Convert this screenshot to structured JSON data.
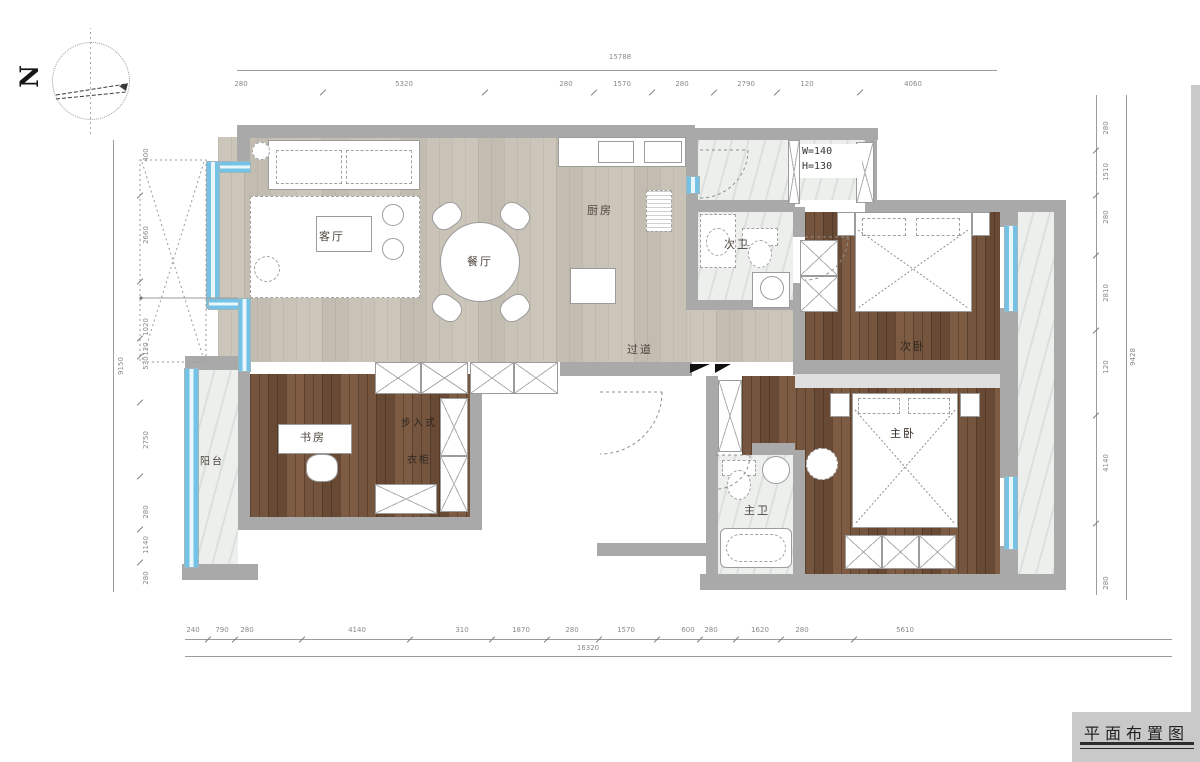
{
  "north_label": "N",
  "title": "平面布置图",
  "note": {
    "w": "W=140",
    "h": "H=130"
  },
  "rooms": {
    "living": "客厅",
    "dining": "餐厅",
    "kitchen": "厨房",
    "guest_bath": "次卫",
    "hallway": "过道",
    "guest_bedroom": "次卧",
    "master_bedroom": "主卧",
    "master_bath": "主卫",
    "study": "书房",
    "closet_line1": "步入式",
    "closet_line2": "衣柜",
    "balcony": "阳台"
  },
  "dimensions": {
    "top": {
      "total": "15788",
      "segments": [
        "280",
        "5320",
        "280",
        "1570",
        "280",
        "2790",
        "120",
        "4060"
      ]
    },
    "bottom": {
      "total": "16320",
      "segments": [
        "240",
        "790",
        "280",
        "4140",
        "310",
        "1870",
        "280",
        "1570",
        "600",
        "280",
        "1620",
        "280",
        "5610"
      ]
    },
    "left": {
      "total": "9150",
      "segments": [
        "400",
        "2660",
        "1020",
        "120",
        "530",
        "2750",
        "280",
        "1140",
        "280"
      ]
    },
    "right": {
      "total": "9428",
      "segments": [
        "280",
        "1510",
        "280",
        "2810",
        "120",
        "4140",
        "280"
      ]
    }
  }
}
